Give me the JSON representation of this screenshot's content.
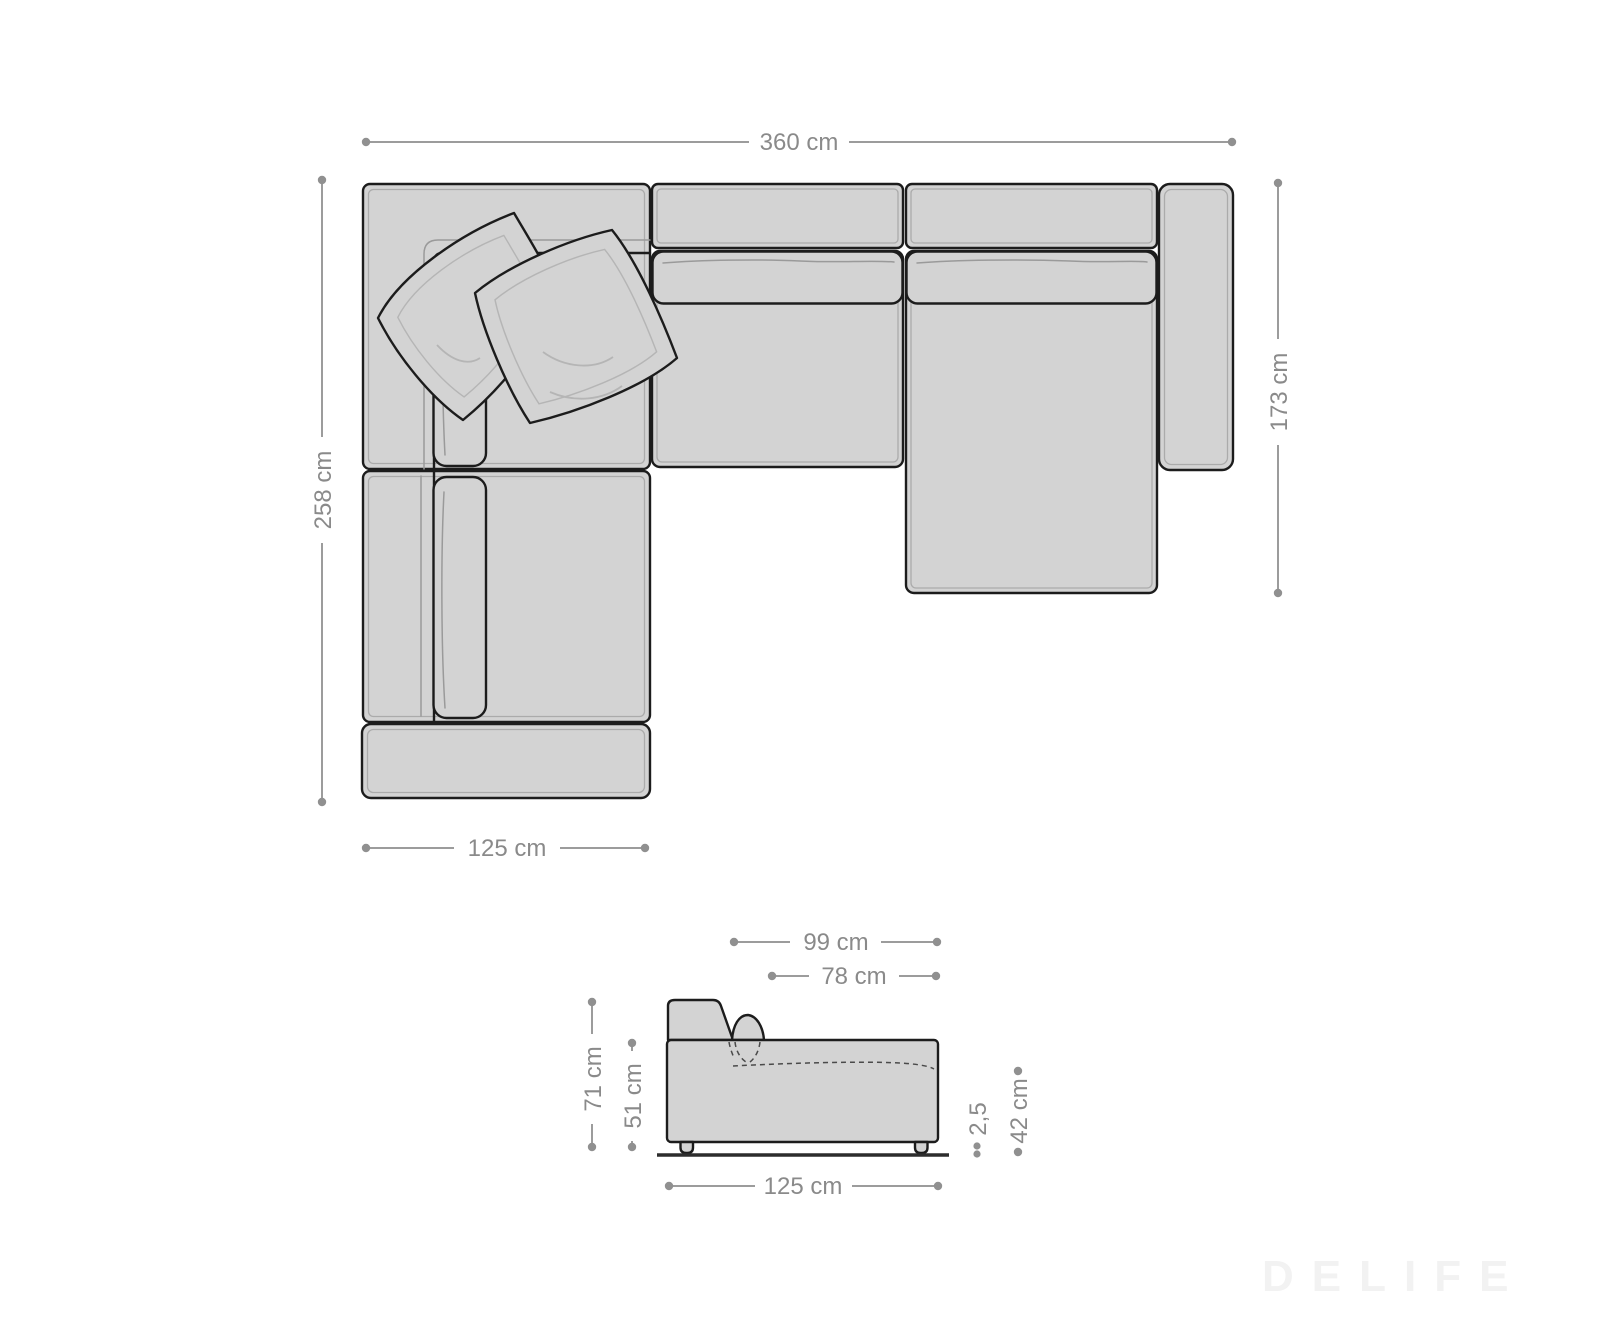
{
  "diagram": {
    "top_view": {
      "total_width_label": "360 cm",
      "total_depth_label": "258 cm",
      "chaise_depth_label": "173 cm",
      "corner_width_label": "125 cm"
    },
    "side_view": {
      "overall_depth_label": "99 cm",
      "seat_depth_label": "78 cm",
      "back_height_label": "71 cm",
      "body_height_label": "51 cm",
      "ground_clearance_label": "2,5",
      "seat_height_label": "42 cm",
      "width_label": "125 cm"
    },
    "watermark": "DELIFE",
    "colors": {
      "upholstery_fill": "#d3d3d3",
      "outline": "#1c1c1c",
      "seam": "#ababab",
      "dimension": "#8f8f8f",
      "watermark_color": "#f2f2f2",
      "background": "#ffffff"
    }
  }
}
